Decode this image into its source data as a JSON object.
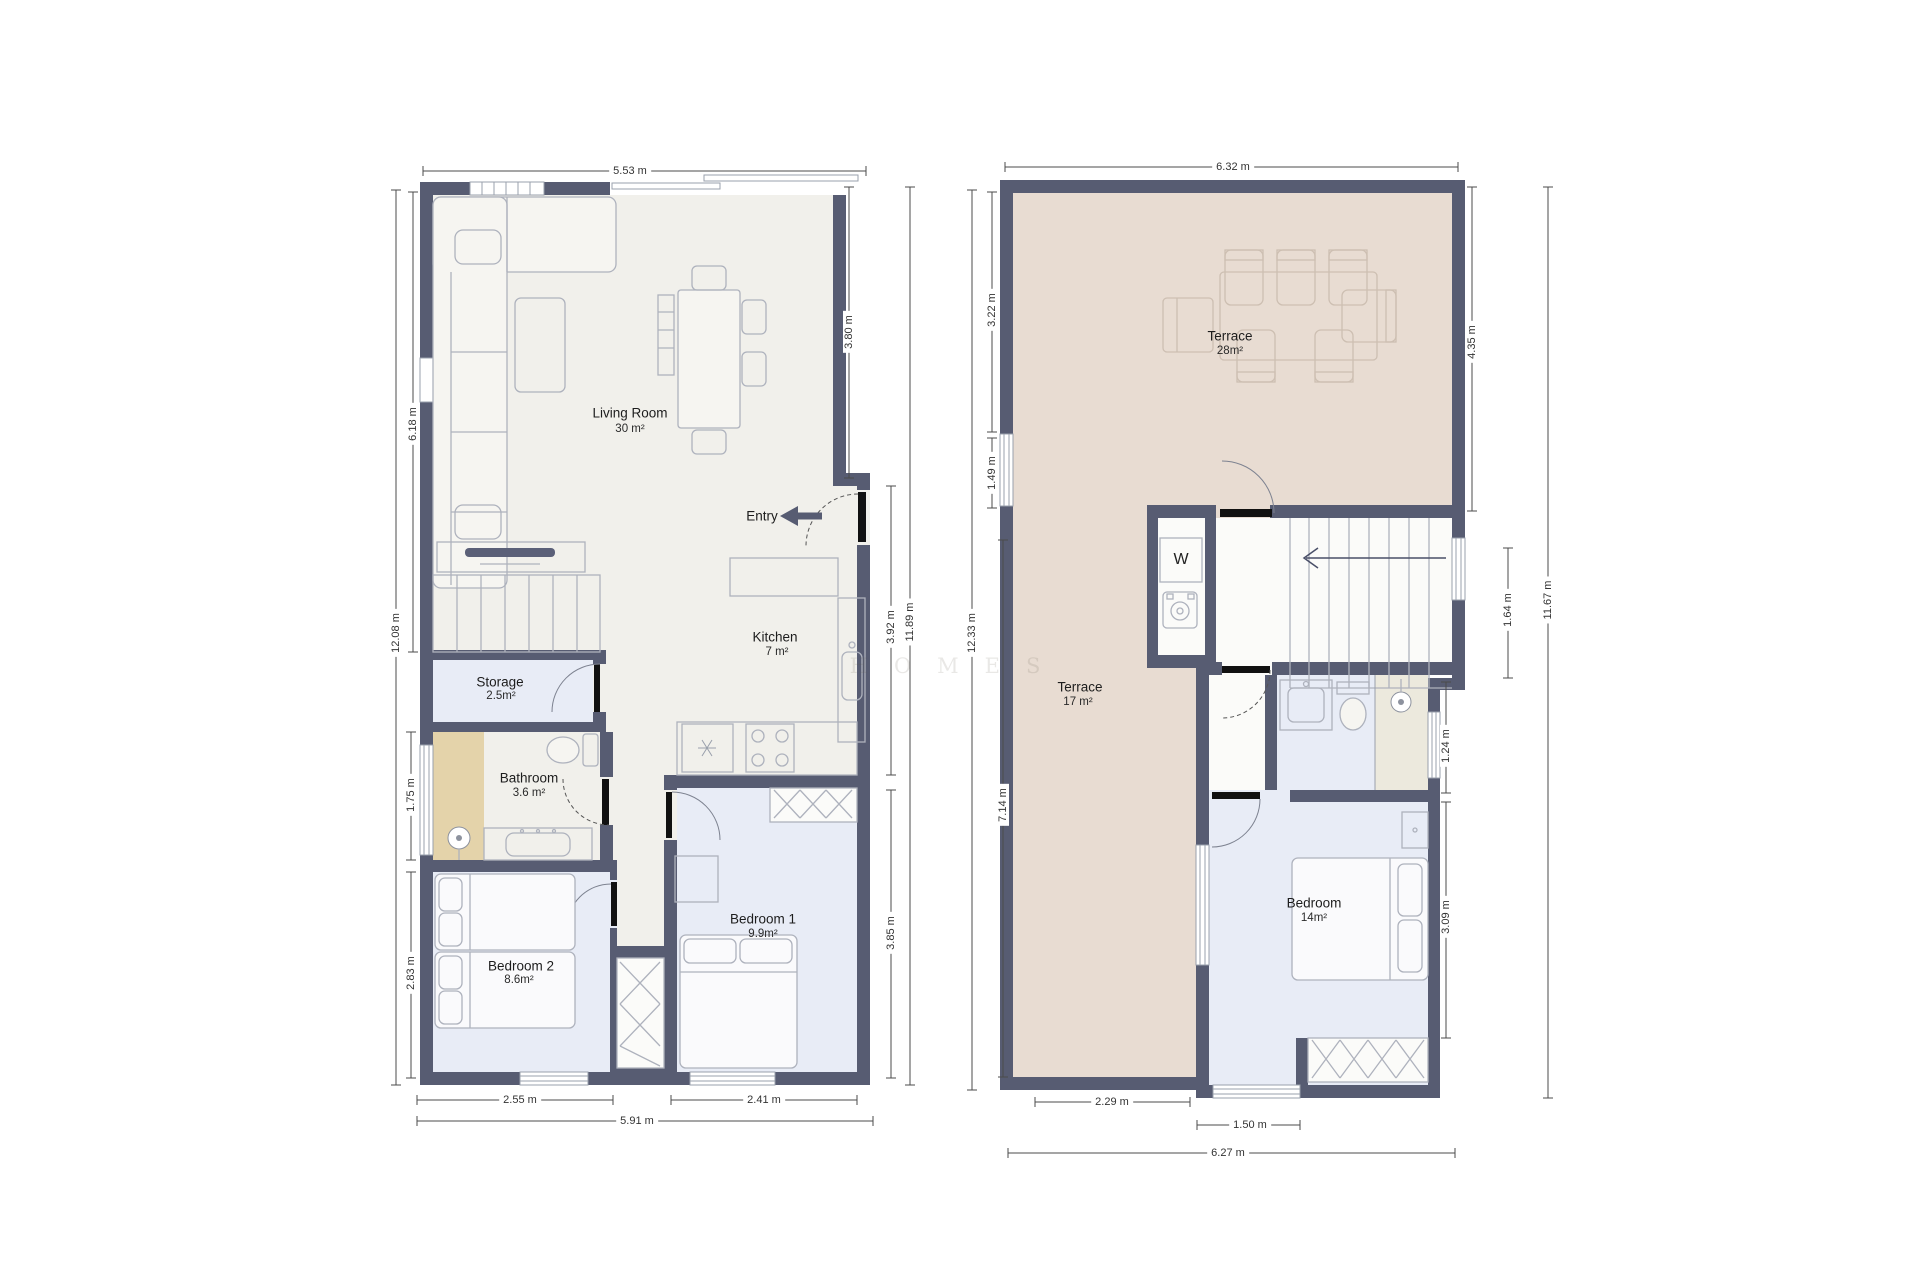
{
  "plan1": {
    "rooms": {
      "living": {
        "name": "Living Room",
        "area": "30 m²"
      },
      "kitchen": {
        "name": "Kitchen",
        "area": "7 m²"
      },
      "storage": {
        "name": "Storage",
        "area": "2.5m²"
      },
      "bathroom": {
        "name": "Bathroom",
        "area": "3.6 m²"
      },
      "bedroom1": {
        "name": "Bedroom 1",
        "area": "9.9m²"
      },
      "bedroom2": {
        "name": "Bedroom 2",
        "area": "8.6m²"
      },
      "entry": {
        "name": "Entry"
      }
    },
    "dims": {
      "top": "5.53 m",
      "left_upper": "6.18 m",
      "left_total": "12.08 m",
      "left_bath": "1.75 m",
      "left_bed2": "2.83 m",
      "right_upper": "3.80 m",
      "right_kitchen": "3.92 m",
      "right_total": "11.89 m",
      "right_bed1": "3.85 m",
      "bottom_bed2": "2.55 m",
      "bottom_total": "5.91 m",
      "bottom_bed1": "2.41 m"
    }
  },
  "plan2": {
    "rooms": {
      "terrace_main": {
        "name": "Terrace",
        "area": "28m²"
      },
      "terrace_side": {
        "name": "Terrace",
        "area": "17 m²"
      },
      "bedroom": {
        "name": "Bedroom",
        "area": "14m²"
      },
      "washer": {
        "label": "W"
      }
    },
    "dims": {
      "top": "6.32 m",
      "left_upper": "3.22 m",
      "left_mid": "1.49 m",
      "left_total": "12.33 m",
      "left_lower": "7.14 m",
      "right_terrace": "4.35 m",
      "right_stairs": "1.64 m",
      "right_total": "11.67 m",
      "right_bath": "1.24 m",
      "right_bedroom": "3.09 m",
      "bottom_terrace": "2.29 m",
      "bottom_window": "1.50 m",
      "bottom_total": "6.27 m"
    }
  },
  "watermark": "HOMES",
  "colors": {
    "wall": "#575C72",
    "floor": "#F1F0EB",
    "room_blue": "#E8ECF6",
    "terrace": "#E8DCD2",
    "shower": "#E4D3AA"
  }
}
